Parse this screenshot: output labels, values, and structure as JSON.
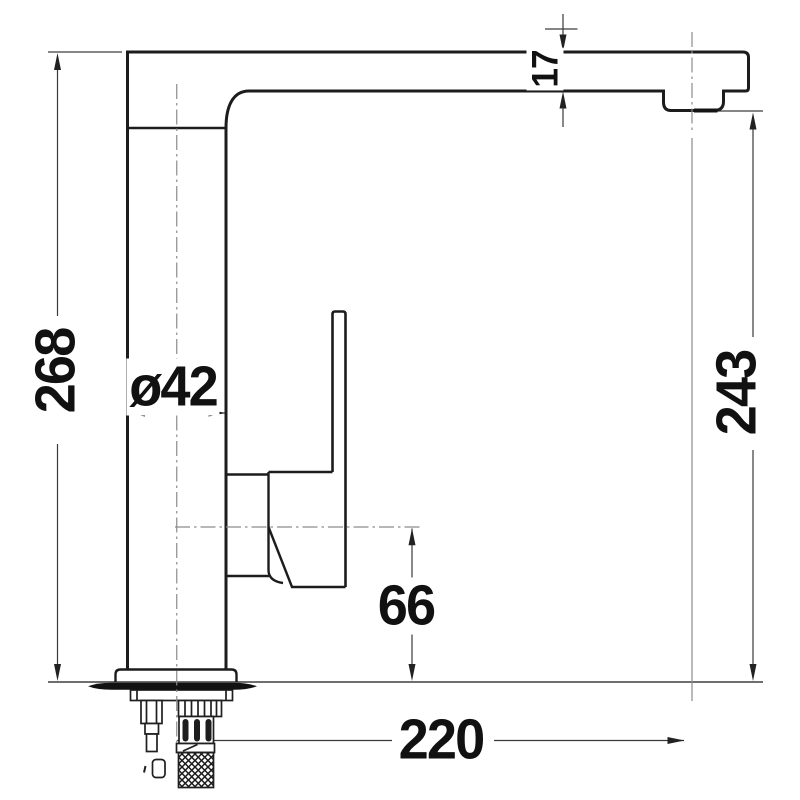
{
  "drawing": {
    "type": "technical-drawing",
    "view": "side elevation of single-lever kitchen mixer tap with installation dimensions",
    "dimensions": {
      "overall_height": "268",
      "spout_outlet_height": "243",
      "spout_thickness": "17",
      "body_diameter": "ø42",
      "handle_axis_height": "66",
      "spout_reach": "220"
    },
    "colors": {
      "background": "#ffffff",
      "outline": "#1c1c1c",
      "dimension_line": "#3a3a3a",
      "centerline": "#8c8c8c",
      "text": "#111111",
      "gasket_fill": "#121212"
    }
  }
}
